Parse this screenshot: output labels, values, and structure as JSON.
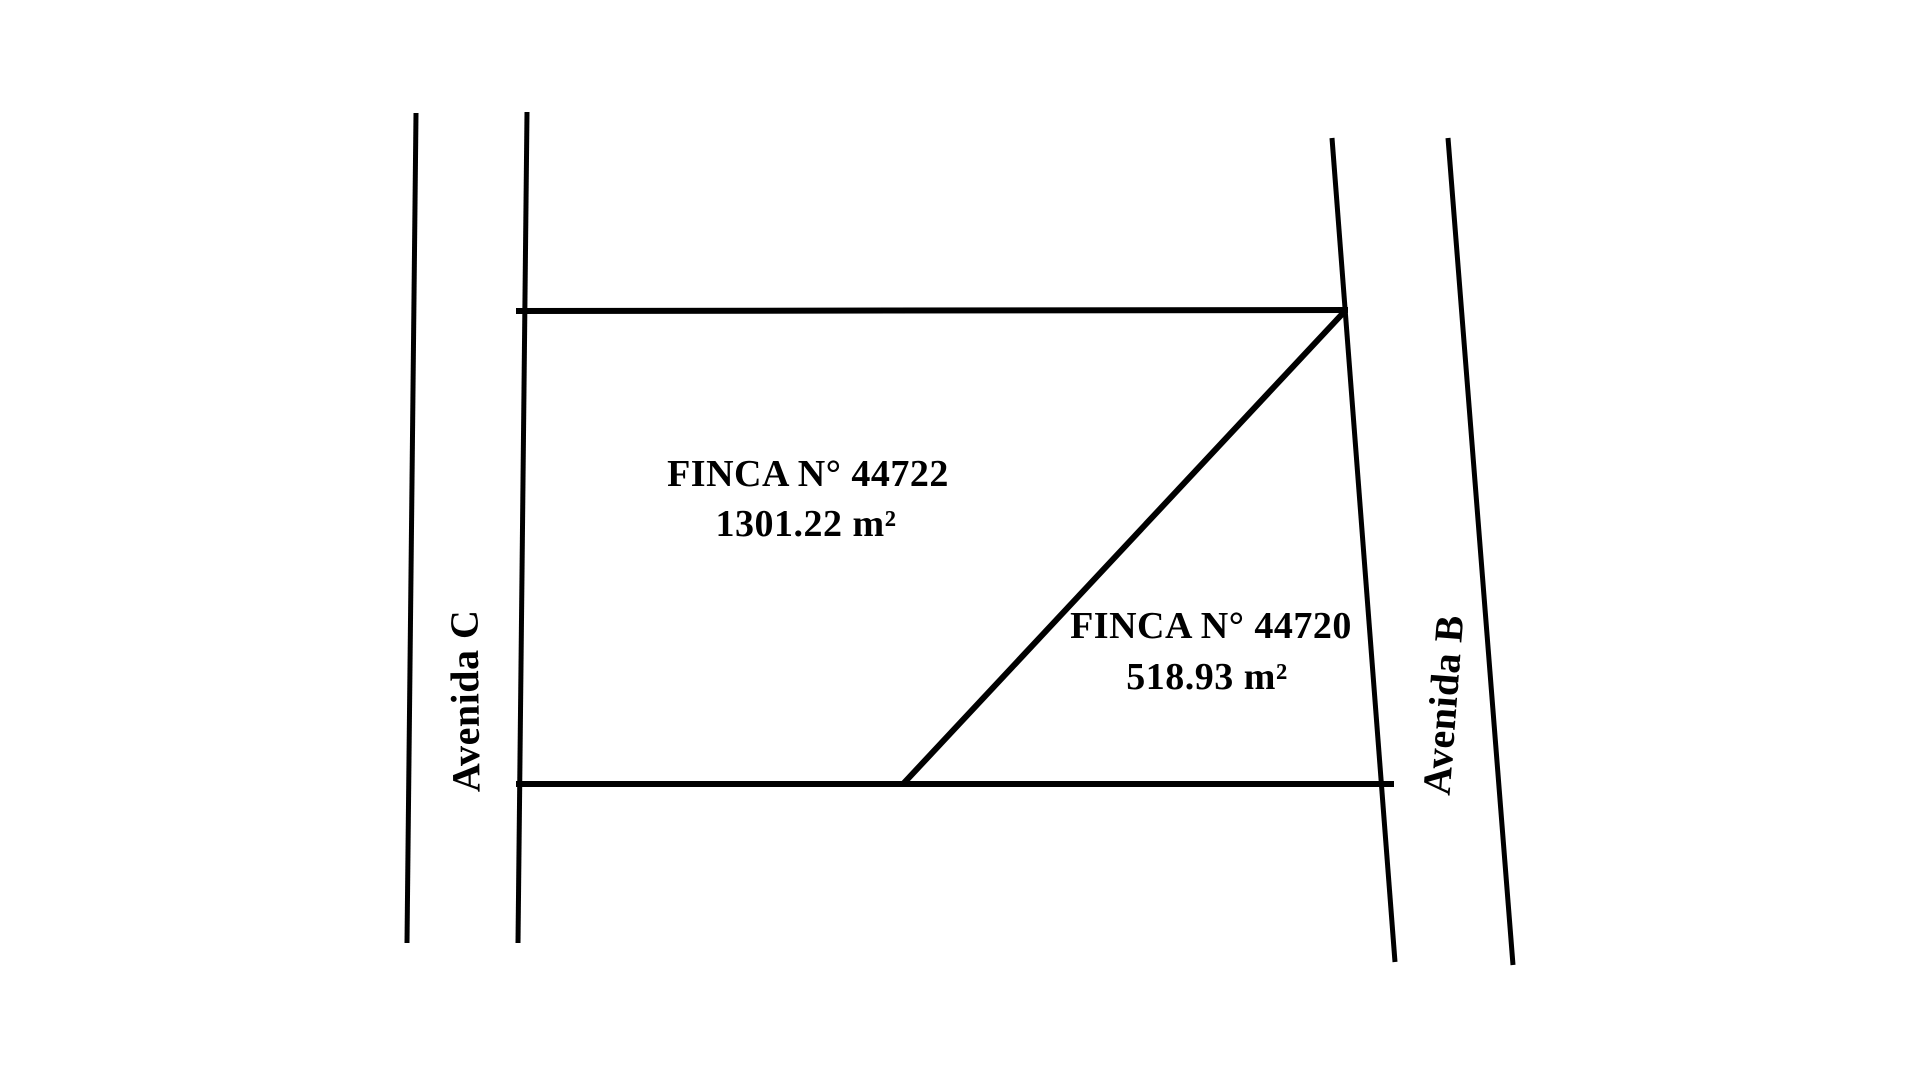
{
  "page": {
    "background": "#ffffff"
  },
  "diagram": {
    "type": "cadastral-plot-sketch",
    "line_color": "#000000",
    "text_color": "#000000",
    "parcels": [
      {
        "label": "FINCA N° 44722",
        "area": "1301.22 m²"
      },
      {
        "label": "FINCA N° 44720",
        "area": "518.93 m²"
      }
    ],
    "streets": [
      {
        "label": "Avenida C",
        "side": "left"
      },
      {
        "label": "Avenida B",
        "side": "right"
      }
    ]
  }
}
